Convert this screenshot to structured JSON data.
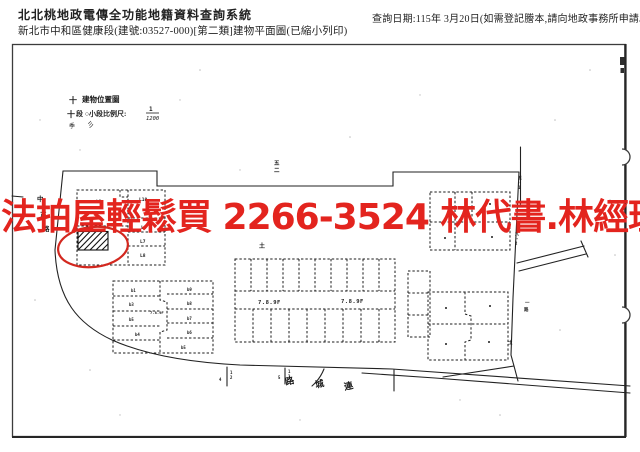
{
  "header": {
    "system_title": "北北桃地政電傳全功能地籍資料查詢系統",
    "document_title": "新北市中和區健康段(建號:03527-000)[第二類]建物平面圖(已縮小列印)",
    "query_date_note": "查詢日期:115年 3月20日(如需登記謄本,請向地政事務所申請。)"
  },
  "watermark": {
    "text": "法拍屋輕鬆買 2266-3524 林代書.林經理",
    "color": "#e3241e"
  },
  "plan": {
    "location_map": {
      "title": "建物位置圖",
      "scale_prefix": "段 ○小段比例尺:",
      "scale_numerator": "1",
      "scale_denominator": "1200",
      "marks": [
        "十",
        "十",
        "季",
        "彡"
      ]
    },
    "left_cluster": {
      "units": [
        "L1",
        "L10",
        "L6",
        "L7",
        "L8"
      ]
    },
    "center_cluster": {
      "floor_label": "7.8.9F"
    },
    "bottom_left_cluster": {
      "floor_label": "7.8.9F",
      "units_left": [
        "b1",
        "b3",
        "b5",
        "b4"
      ],
      "units_right": [
        "b9",
        "b8",
        "b7",
        "b6",
        "b5"
      ]
    },
    "roads": {
      "bottom_road_chars": [
        "路",
        "城",
        "連"
      ],
      "left_road_chars": [
        "中",
        "正",
        "路"
      ]
    },
    "tiny_marks": {
      "block_no_top": "五",
      "block_no_bottom": "二",
      "mark_center": "土",
      "lot_right_top": [
        "五",
        "-",
        "1"
      ],
      "lot_branch": [
        "九",
        "-",
        "2"
      ],
      "lane_name": [
        "一",
        "路"
      ],
      "lot_corner": "土",
      "tick1": [
        "1",
        "2",
        "4"
      ],
      "tick2": [
        "1",
        "2",
        "5"
      ]
    }
  }
}
